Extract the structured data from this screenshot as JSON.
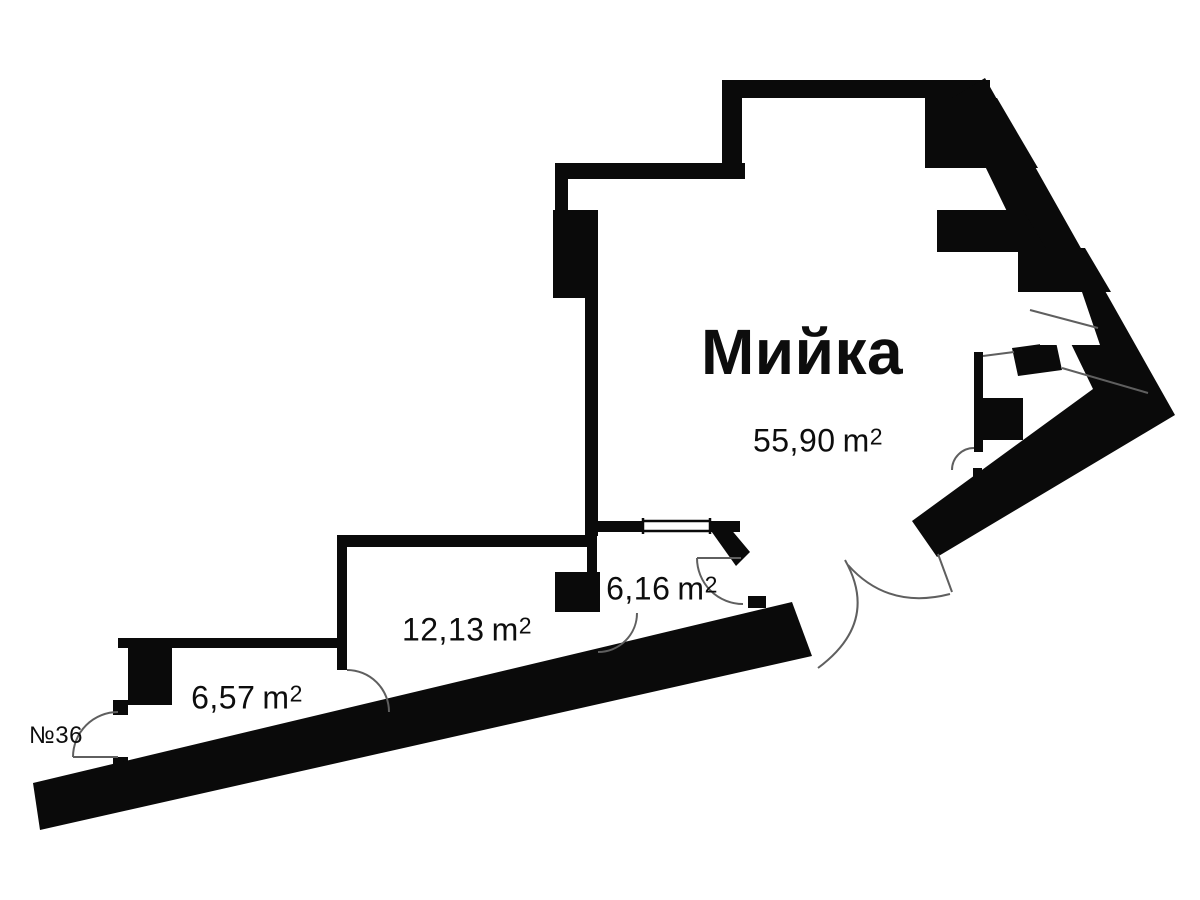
{
  "floorplan": {
    "background": "#ffffff",
    "wall_color": "#0a0a0a",
    "arc_line_color": "#5f5f5f",
    "unit_number": "№36",
    "area_suffix": "m",
    "area_superscript": "2",
    "rooms": [
      {
        "id": "washroom",
        "name": "Мийка",
        "area": "55,90"
      },
      {
        "id": "room-1213",
        "name": "",
        "area": "12,13"
      },
      {
        "id": "room-616",
        "name": "",
        "area": "6,16"
      },
      {
        "id": "room-657",
        "name": "",
        "area": "6,57"
      }
    ]
  }
}
